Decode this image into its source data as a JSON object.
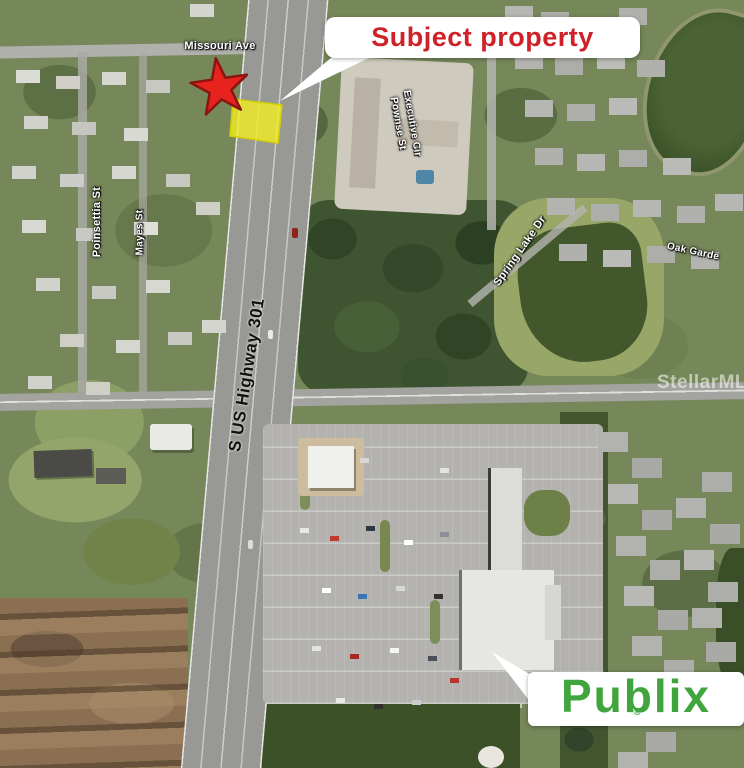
{
  "annotations": {
    "subject_callout": {
      "text": "Subject property",
      "text_color": "#cf2128",
      "box_color": "#ffffff"
    },
    "publix_logo": {
      "wordmark": "Publix",
      "registered": "®",
      "green": "#3fa53c",
      "box_color": "#ffffff"
    },
    "star_marker": {
      "shape": "red-star",
      "fill": "#e8231d",
      "stroke": "#8c1410"
    },
    "parcel_highlight": {
      "fill": "#f0ec24",
      "stroke": "#d6d000"
    },
    "watermark": {
      "text": "StellarMLS"
    }
  },
  "street_labels": {
    "missouri_ave": "Missouri Ave",
    "poinsettia_st": "Poinsettia St",
    "mayes_st": "Mayes St",
    "highway": "S US Highway 301",
    "executive_cir": "Executive Cir",
    "pownse_st": "Pownse St",
    "spring_lake_dr": "Spring Lake Dr",
    "oak_garden": "Oak Garde",
    "label_color": "#ffffff",
    "highway_label_color": "#111111"
  },
  "map_features": {
    "highway_color": "#989894",
    "water_color": "#42582c",
    "dirt_color": "#8a6f52",
    "parking_color": "#b3b2ae"
  }
}
